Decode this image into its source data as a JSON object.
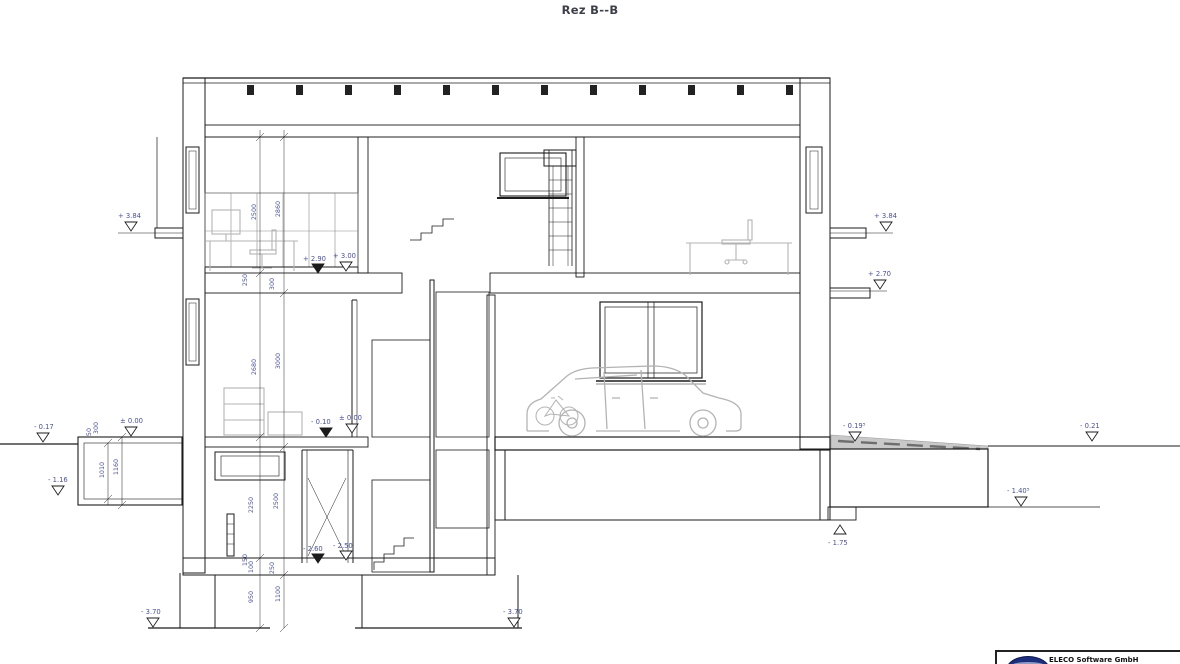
{
  "title": "Rez B--B",
  "drawing": {
    "kind": "architectural-section",
    "description": "Building cross-section B-B with three storeys, spiral stair, garage with car, basement and foundations"
  },
  "elevation_marks": [
    {
      "text": "+ 3.84"
    },
    {
      "text": "- 0.17"
    },
    {
      "text": "± 0.00"
    },
    {
      "text": "- 1.16"
    },
    {
      "text": "- 3.70"
    },
    {
      "text": "+ 2.90"
    },
    {
      "text": "+ 3.00"
    },
    {
      "text": "- 0.10"
    },
    {
      "text": "± 0.00"
    },
    {
      "text": "- 2.60"
    },
    {
      "text": "- 2.50"
    },
    {
      "text": "- 3.70"
    },
    {
      "text": "+ 3.84"
    },
    {
      "text": "+ 2.70"
    },
    {
      "text": "- 0.19⁵"
    },
    {
      "text": "- 0.21"
    },
    {
      "text": "- 1.40⁵"
    },
    {
      "text": "- 1.75"
    }
  ],
  "dimensions": [
    {
      "text": "2500"
    },
    {
      "text": "2860"
    },
    {
      "text": "250"
    },
    {
      "text": "300"
    },
    {
      "text": "2680"
    },
    {
      "text": "3000"
    },
    {
      "text": "50"
    },
    {
      "text": "300"
    },
    {
      "text": "1010"
    },
    {
      "text": "1160"
    },
    {
      "text": "2250"
    },
    {
      "text": "2500"
    },
    {
      "text": "150"
    },
    {
      "text": "100"
    },
    {
      "text": "250"
    },
    {
      "text": "950"
    },
    {
      "text": "1100"
    }
  ],
  "logo": {
    "company": "ELECO Software GmbH",
    "accent": "#1d2f7c"
  },
  "colors": {
    "line": "#1b1b1b",
    "annotation": "#4b5394",
    "furniture": "#b3b3b3"
  }
}
